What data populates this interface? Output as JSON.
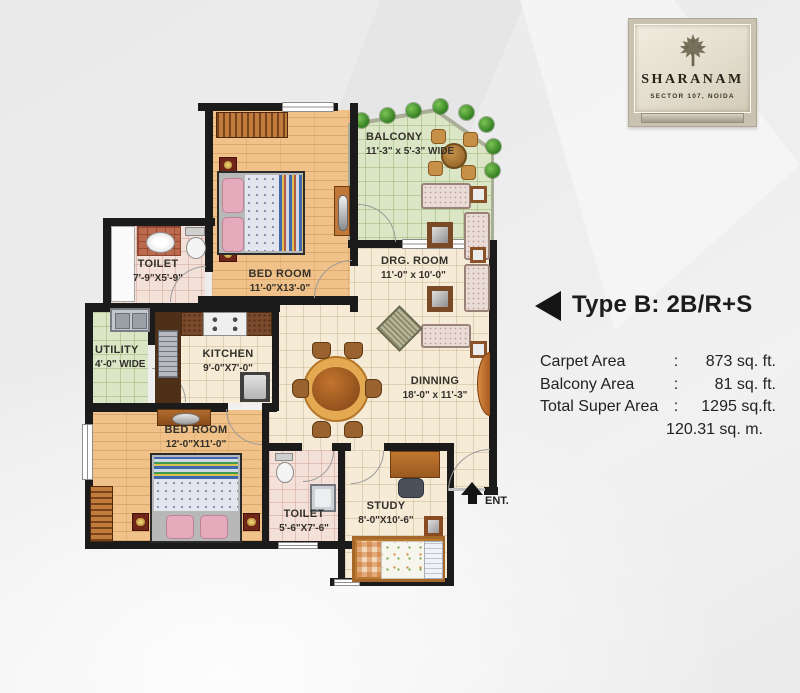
{
  "logo": {
    "title": "SHARANAM",
    "subtitle": "SECTOR 107, NOIDA"
  },
  "unit": {
    "type_label": "Type B: 2B/R+S",
    "sep": ":",
    "areas": [
      {
        "label": "Carpet Area",
        "value": "873 sq. ft."
      },
      {
        "label": "Balcony Area",
        "value": "81 sq. ft."
      },
      {
        "label": "Total Super Area",
        "value": "1295 sq.ft."
      }
    ],
    "metric_value": "120.31 sq. m."
  },
  "rooms": {
    "balcony": {
      "name": "BALCONY",
      "dims": "11'-3\" x 5'-3\" WIDE"
    },
    "bedroom_top": {
      "name": "BED ROOM",
      "dims": "11'-0\"X13'-0\""
    },
    "toilet_top": {
      "name": "TOILET",
      "dims": "7'-9\"X5'-9\""
    },
    "drg_room": {
      "name": "DRG. ROOM",
      "dims": "11'-0\" x 10'-0\""
    },
    "utility": {
      "name": "UTILITY",
      "dims": "4'-0\" WIDE"
    },
    "kitchen": {
      "name": "KITCHEN",
      "dims": "9'-0\"X7'-0\""
    },
    "dinning": {
      "name": "DINNING",
      "dims": "18'-0\" x 11'-3\""
    },
    "bedroom_bottom": {
      "name": "BED ROOM",
      "dims": "12'-0\"X11'-0\""
    },
    "toilet_bottom": {
      "name": "TOILET",
      "dims": "5'-6\"X7'-6\""
    },
    "study": {
      "name": "STUDY",
      "dims": "8'-0\"X10'-6\""
    },
    "entrance": {
      "label": "ENT."
    }
  },
  "colors": {
    "wall": "#1b1b1b",
    "wood_floor": "#f0c28a",
    "tile_cream": "#f5ebd7",
    "tile_green": "#dbe6c6",
    "tile_pink": "#f2e0d9",
    "accent_orange": "#c07838",
    "plant_green": "#2f7a1f",
    "background": "#ececec"
  }
}
